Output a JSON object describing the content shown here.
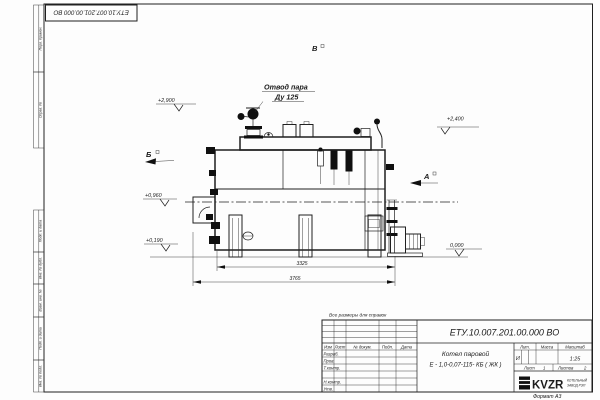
{
  "frame": {
    "stamp_top_left": "ЕТУ.10.007.201.00.000  ВО",
    "format_note": "Формат А3",
    "reference_note": "Все размеры для справок",
    "margin_labels": [
      "Перв. примен.",
      "Справ. №",
      "Подп. и дата",
      "Инв. № дубл.",
      "Взам. инв. №",
      "Подп. и дата",
      "Инв. № подл."
    ]
  },
  "annotations": {
    "steam_outlet_line1": "Отвод пара",
    "steam_outlet_line2": "Ду 125",
    "view_a": "А",
    "view_b": "Б",
    "view_v": "В",
    "elevations": {
      "e2900": "+2,900",
      "e2400": "+2,400",
      "e0960": "+0,960",
      "e0190": "+0,190",
      "e0000": "0,000"
    },
    "dimensions": {
      "inner": "3325",
      "overall": "3765"
    }
  },
  "title_block": {
    "designation": "ЕТУ.10.007.201.00.000  ВО",
    "name_line1": "Котел паровой",
    "name_line2": "Е - 1,0-0,07-115- КБ ( ЖК )",
    "headers": {
      "izm": "Изм",
      "list": "Лист",
      "doc": "№ докум.",
      "podp": "Подп.",
      "data": "Дата",
      "lit": "Лит.",
      "massa": "Масса",
      "masshtab": "Масштаб"
    },
    "rows": {
      "razrab": "Разраб.",
      "prov": "Пров.",
      "tkontr": "Т.контр.",
      "nkontr": "Н.контр.",
      "utv": "Утв."
    },
    "lit_value": "И",
    "scale": "1:25",
    "sheet_label": "Лист",
    "sheet_value": "1",
    "sheets_label": "Листов",
    "sheets_value": "2",
    "logo_text": "KVZR",
    "logo_caption_line1": "КОТЕЛЬНЫЙ",
    "logo_caption_line2": "ЗАВОД РЭП"
  }
}
